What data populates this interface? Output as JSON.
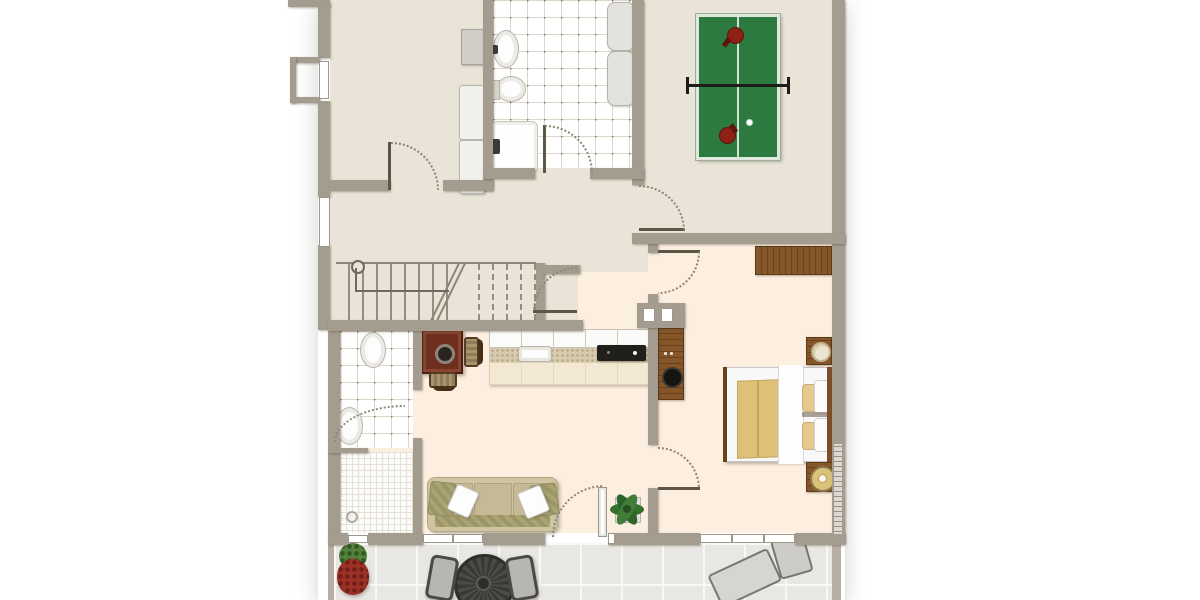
{
  "scene": {
    "type": "residential-floor-plan",
    "view": "top-down",
    "description": "Color floor plan with game room, two bathrooms, hallway with staircase, open kitchen-living room, bedroom and rear patio"
  },
  "rooms": [
    {
      "id": 0,
      "name": "storage-room",
      "floor": "beige",
      "items": [
        "gray-cabinet",
        "white-wardrobe",
        "white-wardrobe",
        "window-well",
        "window-well",
        "door"
      ]
    },
    {
      "id": 1,
      "name": "main-bathroom",
      "floor": "white-tile-with-dots",
      "items": [
        "pedestal-sink",
        "toilet",
        "shower-pan",
        "bench",
        "bench",
        "door"
      ]
    },
    {
      "id": 2,
      "name": "game-room",
      "floor": "beige",
      "items": [
        "ping-pong-table",
        "paddle-red",
        "paddle-red",
        "ball-white",
        "door"
      ]
    },
    {
      "id": 3,
      "name": "hallway",
      "floor": "beige",
      "items": [
        "staircase",
        "handrail",
        "window",
        "door-to-kitchen"
      ]
    },
    {
      "id": 4,
      "name": "kitchen-living-room",
      "floor": "cream",
      "items": [
        "kitchen-counter",
        "kitchen-sink",
        "cooktop",
        "dining-table",
        "dining-chair",
        "dining-chair",
        "sofa",
        "potted-plant",
        "patio-glass-door"
      ]
    },
    {
      "id": 5,
      "name": "small-bathroom",
      "floor": "white-tile-with-dots",
      "items": [
        "toilet",
        "pedestal-sink",
        "shower-area",
        "shower-head",
        "drain",
        "door"
      ]
    },
    {
      "id": 6,
      "name": "bedroom",
      "floor": "cream",
      "items": [
        "double-bed",
        "blanket",
        "pillows",
        "nightstand-with-shell",
        "nightstand-with-lamp",
        "wall-shelf",
        "wardrobe-cabinet",
        "utility-block",
        "door",
        "door",
        "window"
      ]
    },
    {
      "id": 7,
      "name": "patio",
      "floor": "gray-tile",
      "items": [
        "round-wicker-table",
        "patio-chair",
        "patio-chair",
        "lounge-chair",
        "flower-pot"
      ]
    }
  ],
  "colors": {
    "wall": "#a49c8e",
    "wall_light": "#b7afa2",
    "floor_beige": "#e9e4d7",
    "floor_cream": "#fcefdf",
    "tile_line": "#dcd7ca",
    "tile_dot": "#837d6d",
    "patio_floor": "#e8e7e3",
    "patio_line": "#f8f8f6",
    "arc": "#8d8577",
    "leaf": "#5f5547",
    "window_fill": "#ffffff",
    "window_frame": "#9d968a",
    "pingpong_green": "#2c7a40",
    "pingpong_frame": "#dfe8dc",
    "net": "#1e1c19",
    "paddle": "#8f2015",
    "wood": "#855628",
    "wood_dark": "#6a411d",
    "table_wood": "#6e2f1f",
    "blanket": "#dec077",
    "pillow_tan": "#e5c98e",
    "linen_white": "#f8f8fa",
    "sofa_frame": "#cfc5a3",
    "sofa_cushion": "#c6ba96",
    "sofa_pattern": "#aaa374",
    "plant_green": "#35702f",
    "counter_top": "#fbfbf9",
    "counter_speck": "#d6cbb0",
    "counter_base": "#f3e8d2",
    "cooktop": "#211f1c",
    "fixture_white": "#fdfdfd",
    "fixture_border": "#b9b4a8",
    "bench_gray": "#e3e2de",
    "cab_gray": "#cfcdc6",
    "wicker": "#4c4b47",
    "chair_gray": "#b7b6b2",
    "lounge": "#d6d5d2",
    "flower_red": "#9e3126",
    "flower_green": "#55813c"
  }
}
